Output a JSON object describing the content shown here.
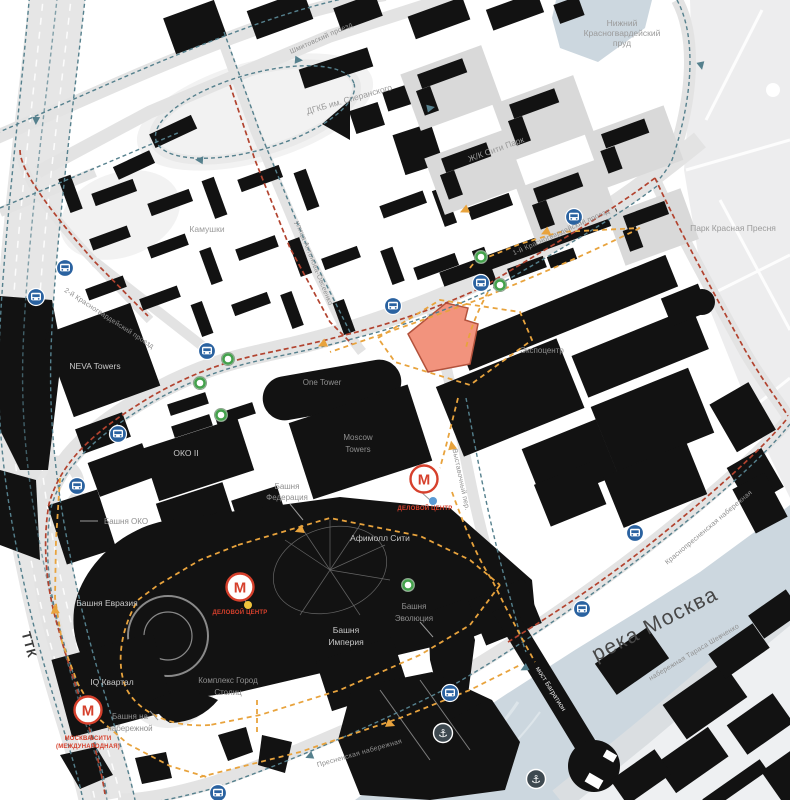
{
  "labels": {
    "pond1": "Нижний",
    "pond2": "Красногвардейский",
    "pond3": "пруд",
    "park": "Парк Красная Пресня",
    "hospital": "ДГКБ им. Сперанского",
    "city_park": "Ж/К Сити Парк",
    "kamushki": "Камушки",
    "shmitovsky": "Шмитовский проезд",
    "antonova": "улица Антонова-Овсеенко",
    "krasnogvardeysky1": "1-й Красногвардейский проезд",
    "krasnogvardeysky2": "2-й Красногвардейский проезд",
    "neva": "NEVA Towers",
    "oko2": "ОКО II",
    "oko_tower": "Башня ОКО",
    "federation1": "Башня",
    "federation2": "Федерация",
    "one_tower": "One Tower",
    "moscow1": "Moscow",
    "moscow2": "Towers",
    "afimall": "Афимолл Сити",
    "expo": "Экспоцентр",
    "eurasia": "Башня Евразия",
    "iq": "IQ Квартал",
    "imperia1": "Башня",
    "imperia2": "Империя",
    "evolution1": "Башня",
    "evolution2": "Эволюция",
    "nab_tower1": "Башня на",
    "nab_tower2": "набережной",
    "capitals1": "Комплекс Город",
    "capitals2": "Столиц",
    "river": "река Москва",
    "shevchenko": "набережная Тараса Шевченко",
    "bagration": "мост Багратион",
    "krasnopresnenskaya": "Краснопресненская набережная",
    "presnenskaya": "Пресненская набережная",
    "ttk": "ТТК",
    "vystavochny": "Выставочный пер.",
    "metro_delovoy": "ДЕЛОВОЙ ЦЕНТР",
    "metro_city1": "МОСКВА-СИТИ",
    "metro_city2": "(МЕЖДУНАРОДНАЯ)"
  },
  "icons": {
    "metro_glyph": "М",
    "anchor_glyph": "⚓"
  },
  "colors": {
    "building": "#121212",
    "water": "#ccd7df",
    "park": "#ededee",
    "road": "#e3e3e3",
    "highlight_fill": "#f2937d",
    "highlight_stroke": "#b3523c",
    "route_red": "#b2432f",
    "route_teal": "#55808d",
    "route_orange": "#e8a33d",
    "metro_red": "#d6402c",
    "bus_blue": "#2a62a0",
    "stop_green": "#44a14c",
    "anchor_gray": "#3e4950"
  }
}
